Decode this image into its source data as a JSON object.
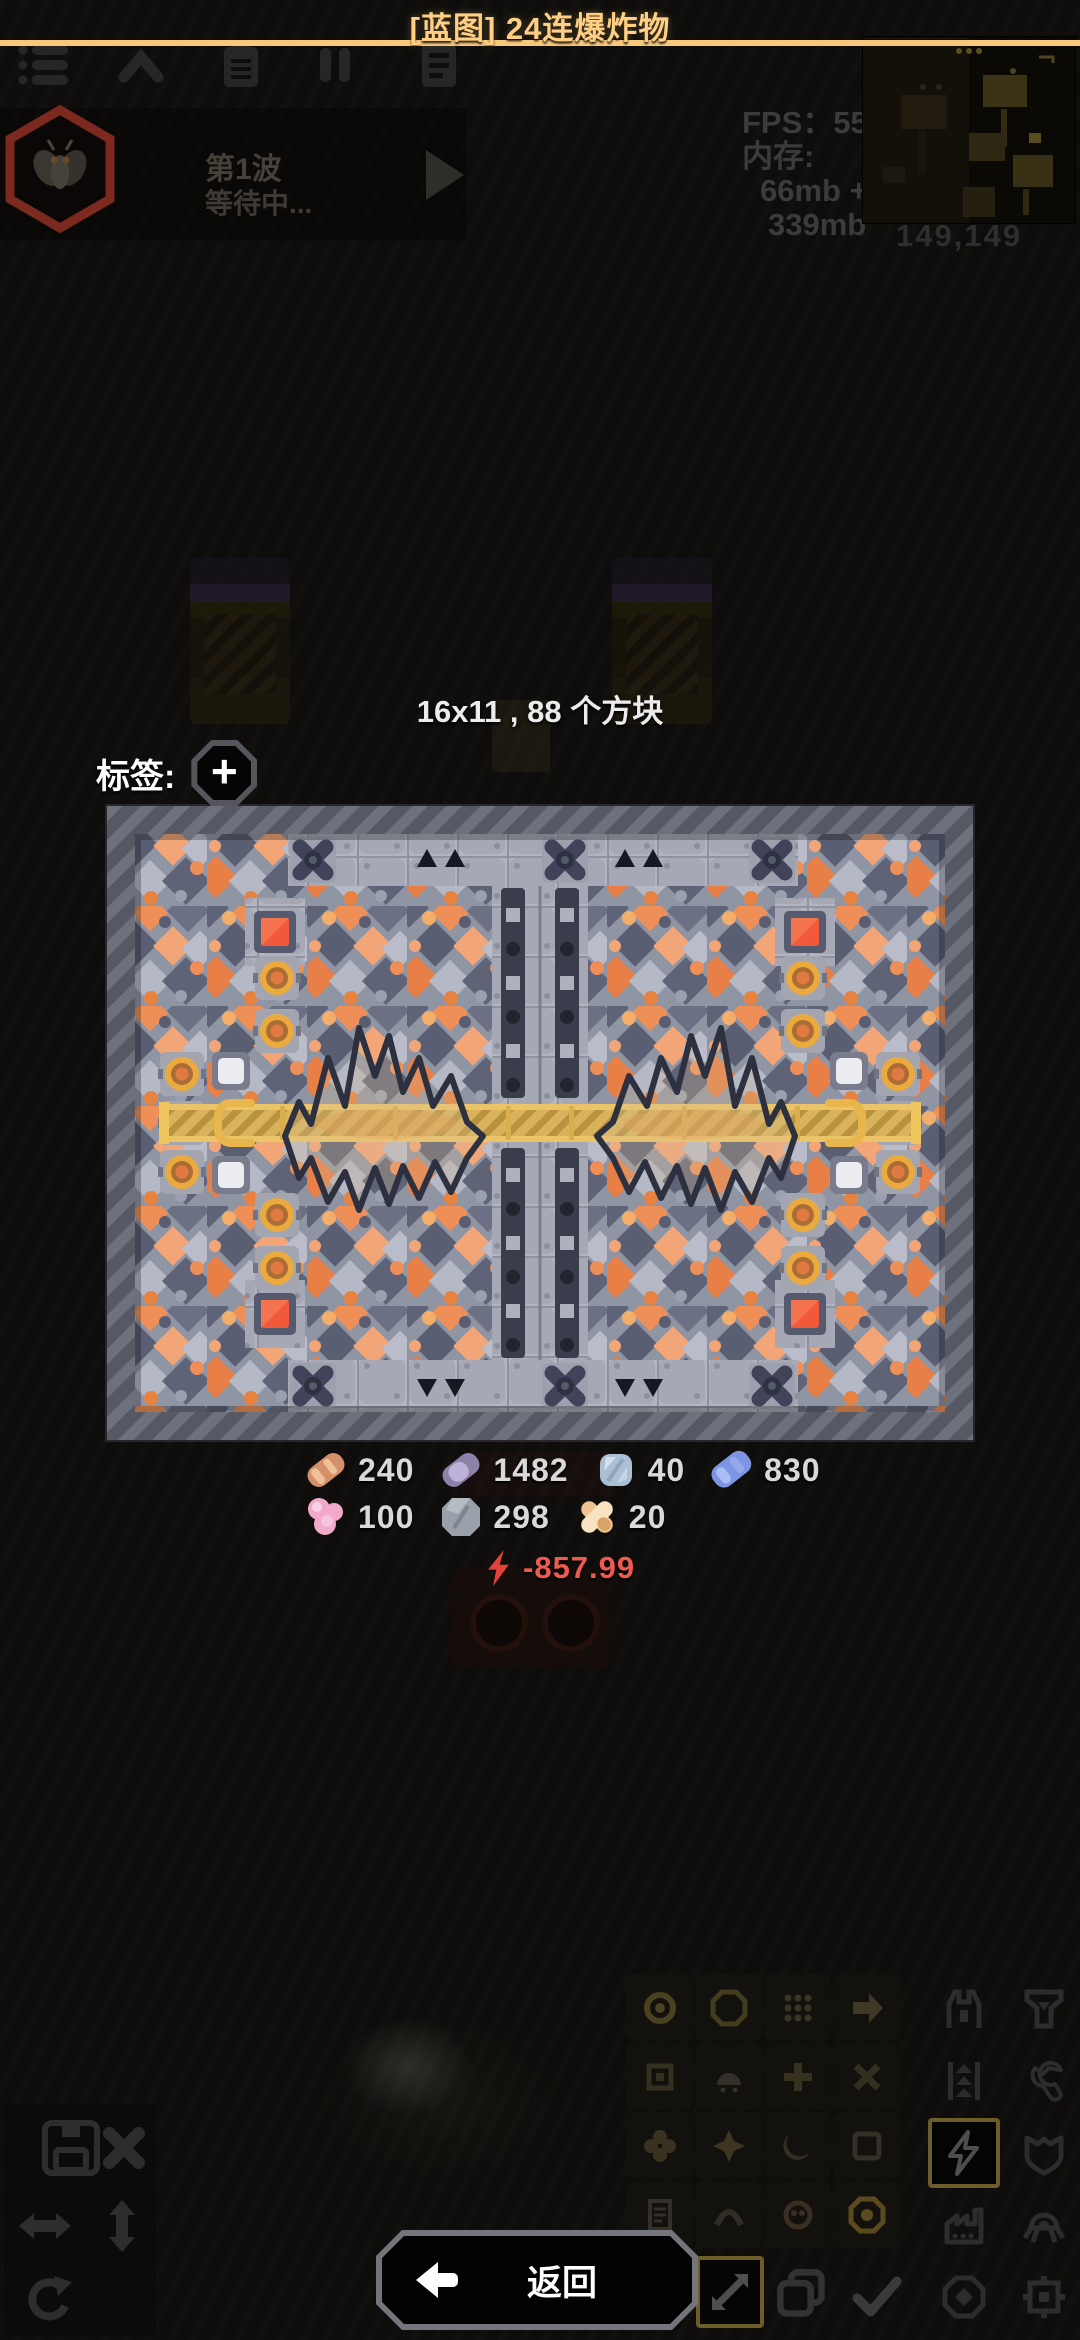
{
  "header": {
    "title": "[蓝图] 24连爆炸物",
    "divider_color": "#f8c97c",
    "toolbar": {
      "menu_icon": "menu-list-icon",
      "hide_icon": "chevron-up-icon",
      "schematics_icon": "clipboard-icon",
      "pause_icon": "pause-icon",
      "database_icon": "notebook-icon"
    },
    "minimap_coords": "149,149"
  },
  "hud": {
    "wave_label": "第1波",
    "wave_status": "等待中...",
    "fps": "FPS：55",
    "memory_label": "内存:",
    "memory_line1": "66mb +",
    "memory_line2": "339mb"
  },
  "dialog": {
    "size_info": "16x11 , 88 个方块",
    "tags_label": "标签:",
    "add_tag_label": "+",
    "costs_row1": [
      {
        "item": "copper",
        "amount": "240",
        "color": "#d3906a"
      },
      {
        "item": "lead",
        "amount": "1482",
        "color": "#8d81a8"
      },
      {
        "item": "metaglass",
        "amount": "40",
        "color": "#abc0d4"
      },
      {
        "item": "titanium",
        "amount": "830",
        "color": "#7e95e4"
      }
    ],
    "costs_row2": [
      {
        "item": "phase-fabric",
        "amount": "100",
        "color": "#f2a9c9"
      },
      {
        "item": "graphite",
        "amount": "298",
        "color": "#9aa0a9"
      },
      {
        "item": "surge-alloy",
        "amount": "20",
        "color": "#eec38f"
      }
    ],
    "power": {
      "value": "-857.99",
      "color": "#e6403a"
    }
  },
  "build_menu": {
    "selected_category": "power",
    "selected_tool": "resize",
    "categories": [
      "turret",
      "production",
      "distribution",
      "crafting",
      "power",
      "defense",
      "factory",
      "units",
      "effect",
      "logic"
    ]
  },
  "footer": {
    "back_label": "返回"
  }
}
